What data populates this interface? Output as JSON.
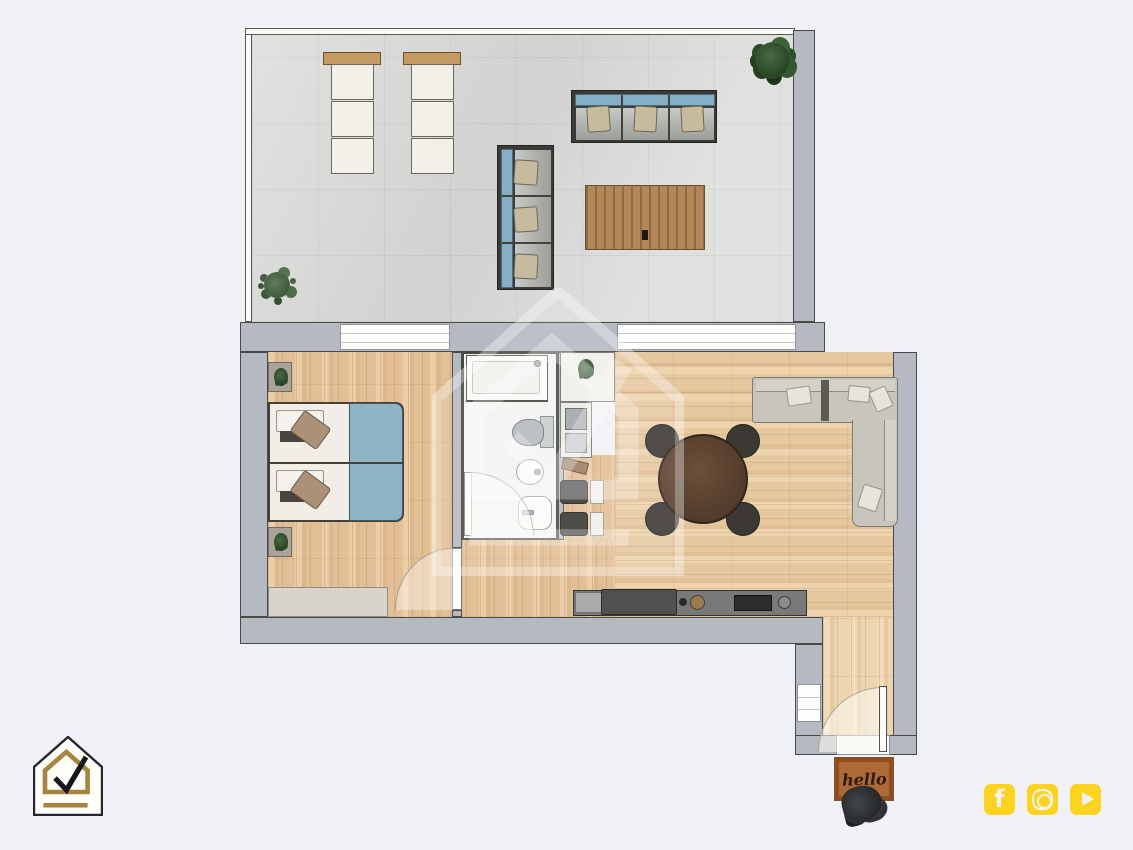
{
  "page": {
    "type": "apartment-floor-plan-render",
    "background": "#f1f2f6"
  },
  "branding": {
    "logo": {
      "name": "house-check-logo",
      "outline_color": "#26262e",
      "accent_color": "#a8843e",
      "check_color": "#17171b"
    },
    "watermark": {
      "name": "house-check-watermark",
      "color": "#ffffff",
      "opacity": 0.36
    }
  },
  "social": {
    "accent": "#fdd31d",
    "icons": [
      {
        "name": "facebook-icon",
        "glyph": "f"
      },
      {
        "name": "instagram-icon"
      },
      {
        "name": "youtube-icon"
      }
    ]
  },
  "entry": {
    "doormat_text": "hello"
  },
  "palette": {
    "wall": "#b5b9c1",
    "wall_outline": "#4a4a48",
    "terrace_tile": "#d9d9d7",
    "wood_floor": "#e2bf95",
    "accent_blue": "#8fb5c4",
    "cushion_beige": "#c7bb9e",
    "sofa_gray": "#c8c5bc",
    "counter_dark": "#77797b",
    "outdoor_table_wood": "#b3875a",
    "dining_table": "#5f4634",
    "chair_dark": "#3c3834",
    "doormat": "#ad6a35"
  },
  "rooms": {
    "terrace": {
      "furniture": [
        "sun-lounger",
        "sun-lounger",
        "outdoor-sofa-3seat",
        "outdoor-sofa-3seat",
        "outdoor-slat-table",
        "potted-plant",
        "potted-plant"
      ]
    },
    "bedroom": {
      "furniture": [
        "double-bed",
        "nightstand",
        "nightstand",
        "wardrobe"
      ]
    },
    "bathroom": {
      "furniture": [
        "shower",
        "toilet",
        "bidet",
        "washbasin"
      ]
    },
    "kitchen": {
      "furniture": [
        "tall-cabinet",
        "counter",
        "sink",
        "cooktop",
        "chairs"
      ]
    },
    "living_room": {
      "furniture": [
        "round-dining-table",
        "dining-chairs-x4",
        "corner-sofa"
      ]
    },
    "entry": {
      "furniture": [
        "doormat",
        "shoes"
      ]
    }
  }
}
